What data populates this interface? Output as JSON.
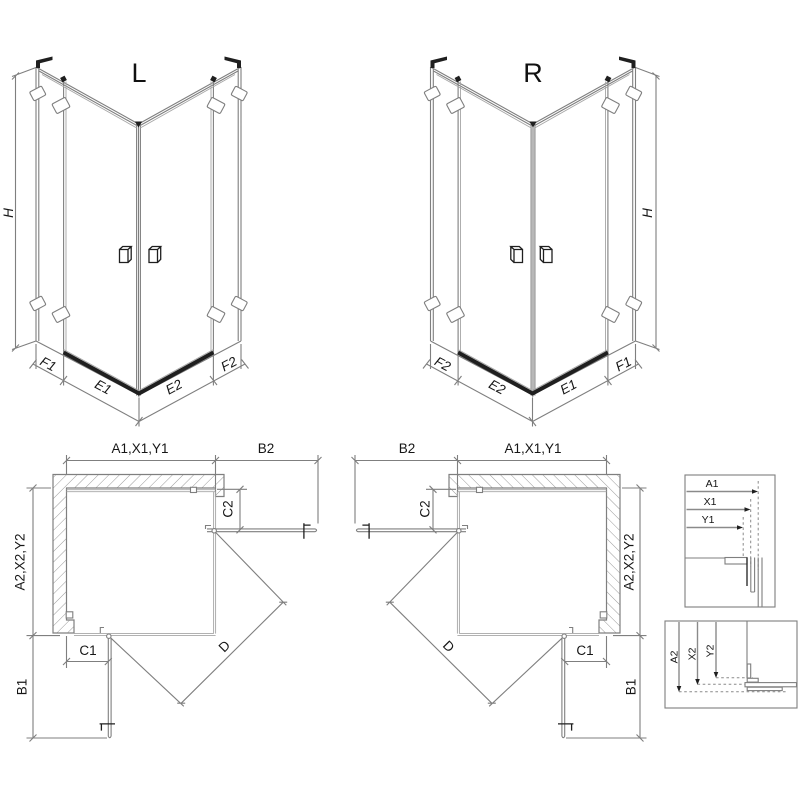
{
  "background": "#ffffff",
  "palette": {
    "line_gray": "#7f7f7f",
    "light_gray": "#a6a6a6",
    "dark": "#1f1f1f",
    "text": "#161616"
  },
  "views": {
    "left_3d": {
      "title": "L",
      "height": "H",
      "f1": "F1",
      "e1": "E1",
      "e2": "E2",
      "f2": "F2"
    },
    "right_3d": {
      "title": "R",
      "height": "H",
      "f1": "F1",
      "e1": "E1",
      "e2": "E2",
      "f2": "F2"
    },
    "left_plan": {
      "top": "A1,X1,Y1",
      "top_side": "B2",
      "side": "A2,X2,Y2",
      "side_bottom": "B1",
      "c1": "C1",
      "c2": "C2",
      "diagonal": "D"
    },
    "right_plan": {
      "top": "A1,X1,Y1",
      "top_side": "B2",
      "side": "A2,X2,Y2",
      "side_bottom": "B1",
      "c1": "C1",
      "c2": "C2",
      "diagonal": "D"
    },
    "detail_horizontal": {
      "a1": "A1",
      "x1": "X1",
      "y1": "Y1"
    },
    "detail_vertical": {
      "a2": "A2",
      "x2": "X2",
      "y2": "Y2"
    }
  }
}
